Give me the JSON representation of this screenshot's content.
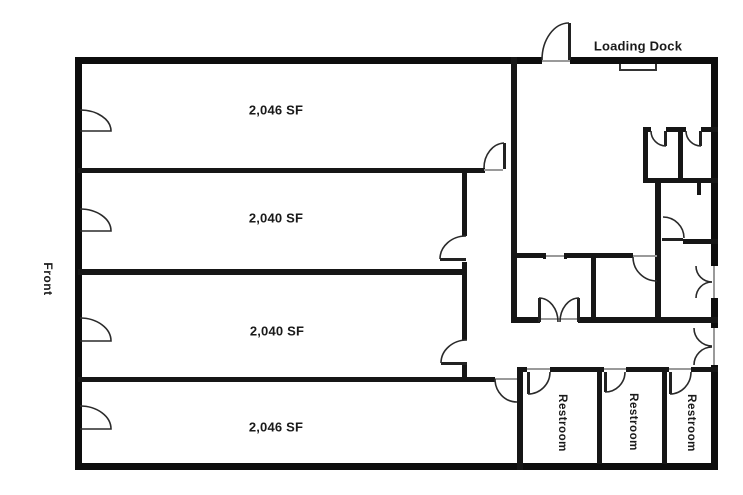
{
  "title": "Office / warehouse floor plan",
  "labels": {
    "front": "Front",
    "loading_dock": "Loading Dock"
  },
  "suites": [
    {
      "label": "2,046 SF"
    },
    {
      "label": "2,040 SF"
    },
    {
      "label": "2,040 SF"
    },
    {
      "label": "2,046 SF"
    }
  ],
  "restrooms": [
    {
      "label": "Restroom"
    },
    {
      "label": "Restroom"
    },
    {
      "label": "Restroom"
    }
  ],
  "colors": {
    "wall": "#101010",
    "door_line": "#2a2a2a",
    "threshold": "#9a9a9a",
    "background": "#ffffff",
    "text": "#1a1a1a"
  }
}
